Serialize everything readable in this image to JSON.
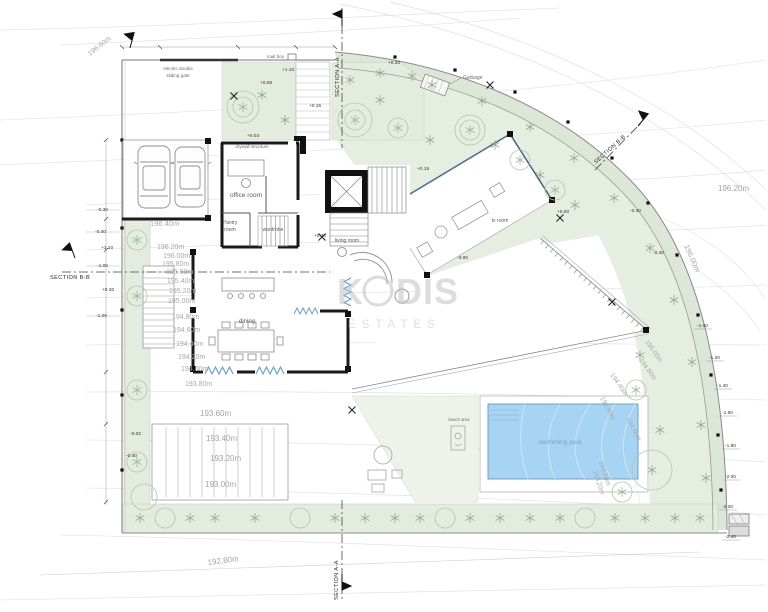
{
  "watermark": {
    "k": "K",
    "dis": "DIS",
    "sub": "ESTATES"
  },
  "sections": {
    "top": "SECTION A-A",
    "bottom": "SECTION A-A",
    "left": "SECTION B-B",
    "right": "SECTION B-B"
  },
  "annotations": {
    "gate_line1": "electric double",
    "gate_line2": "sliding gate",
    "mailbox": "mail box",
    "garbage": "Garbage",
    "drywall": "drywall structure",
    "beach": "beach area"
  },
  "rooms": {
    "office": "office room",
    "pantry_line1": "Pantry",
    "pantry_line2": "room",
    "wardrobe": "wardrobe",
    "dining": "dining",
    "living": "living room",
    "tv": "tv room",
    "pool": "swimming pool"
  },
  "contours": {
    "top_left": "196.60m",
    "garage": "196.40m",
    "left": [
      "196.20m",
      "196.00m",
      "195.80m",
      "195.60m",
      "195.40m",
      "195.20m",
      "195.00m",
      "194.80m",
      "194.60m",
      "194.40m",
      "194.20m",
      "194.00m",
      "193.80m"
    ],
    "ramp": [
      "193.60m",
      "193.40m",
      "193.20m",
      "193.00m"
    ],
    "bottom": "192.80m",
    "right_top": "196.20m",
    "right_mid": "196.00m",
    "pool_side": [
      "195.00m",
      "194.80m",
      "194.40m",
      "193.80m",
      "194.60m",
      "193.60m",
      "193.20m"
    ]
  },
  "levels": [
    "+0.20",
    "+1.10",
    "+0.05",
    "+0.15",
    "+0.03",
    "+0.20",
    "+0.15",
    "+0.00",
    "-3.00",
    "-0.40",
    "-0.40",
    "-1.00",
    "-1.20",
    "-1.40",
    "-1.60",
    "-1.80",
    "-2.00",
    "-2.20",
    "-2.40",
    "-0.30",
    "-0.40",
    "+1.10",
    "-1.00",
    "+0.30",
    "-1.00",
    "-0.03",
    "-0.40"
  ],
  "colors": {
    "pool_fill": "#a7d4f2",
    "pool_edge": "#5e9cc8",
    "landscape_green": "#e3ebdd",
    "band_green": "#dce7d8",
    "wall_black": "#1a1a1a",
    "watermark_gray": "#c2c2c2"
  }
}
